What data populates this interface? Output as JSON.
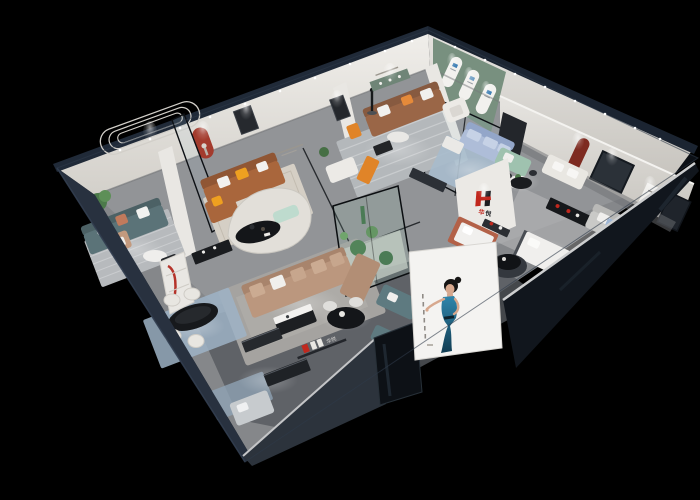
{
  "scene": {
    "kind": "3d-isometric-furniture-showroom-cutaway-render",
    "background": "#000000"
  },
  "brand": {
    "logo_letter": "H",
    "name_cn": "华悦",
    "name_char1": "华",
    "name_char2": "悦",
    "logo_red": "#c1271d",
    "logo_dark": "#1b1c20"
  },
  "palette": {
    "exterior_wall": "#28313f",
    "wall_cap": "#202a38",
    "interior_wall": "#e9e7e3",
    "interior_wall_shade": "#cfccc6",
    "floor": "#85878a",
    "floor_front": "#55595e",
    "green_accent_wall": "#78907f",
    "red_accent": "#b5332a",
    "niche_red": "#a33b2d",
    "niche_maroon": "#7e2b21",
    "sofa_teal": "#5b7378",
    "sofa_cognac": "#a9663c",
    "sofa_brown": "#9a6647",
    "sofa_tan": "#bb977e",
    "sofa_periwinkle": "#aebdd8",
    "sofa_grey": "#c9c9c7",
    "bench_mint": "#bedbce",
    "loveseat_green": "#9fc2af",
    "pillow_terracotta": "#c07a5c",
    "pillow_yellow": "#eea020",
    "accent_orange": "#e08428",
    "rug_blue": "#9db3c6",
    "rug_grey": "#b5b9bc",
    "table_black": "#17191c",
    "poster_background": "#f4f3f1",
    "poster_dress": "#1f6d8c",
    "arch_mark_blue": "#3f7fb5"
  },
  "poster": {
    "subject": "woman in blue evening dress, hand on hip",
    "side_caption": "illegible vertical caption marks"
  },
  "arch_display_wall": {
    "arch_count": 3
  },
  "rooms": [
    {
      "name": "teal-sofa-lounge",
      "items": [
        "teal 3-seat sofa",
        "white and terracotta pillows",
        "potted plant",
        "round side table",
        "black chair",
        "tan armchair",
        "striped rug",
        "oval wall molding"
      ]
    },
    {
      "name": "cognac-leather-lounge",
      "items": [
        "cognac leather sofa with chaise",
        "yellow pillows",
        "black coffee table",
        "red arched niche with sculpture",
        "glass partition",
        "beige rug"
      ]
    },
    {
      "name": "top-center-living",
      "items": [
        "brown leather sofa",
        "white armchair",
        "orange stool and bench",
        "white loveseat",
        "round coffee tables",
        "striped rug",
        "green wall shelf",
        "black sculpture",
        "dark media console"
      ]
    },
    {
      "name": "arched-display-wall",
      "items": [
        "green accent wall",
        "three white arch panels with blue marks"
      ]
    },
    {
      "name": "glass-lounge",
      "items": [
        "periwinkle sofa",
        "white coffee table",
        "dark media wall",
        "glass partition",
        "blue rug"
      ]
    },
    {
      "name": "green-loveseat-corner",
      "items": [
        "sage loveseat",
        "round white table with plant"
      ]
    },
    {
      "name": "right-bedroom-suite",
      "items": [
        "white sofa",
        "grey sofa with blue pillow",
        "white bed",
        "black display rack with red objects",
        "maroon arched niche",
        "dark windows",
        "black round dining table",
        "white art panel"
      ]
    },
    {
      "name": "brand-pillar",
      "items": [
        "red and black H logo",
        "brand characters",
        "dark console"
      ]
    },
    {
      "name": "terracotta-daybed-corner",
      "items": [
        "terracotta daybed with white mattress"
      ]
    },
    {
      "name": "central-living",
      "items": [
        "tan sectional sofa",
        "black and white coffee table",
        "curved white partition",
        "mint bench",
        "black oval table with vases",
        "glass planter atrium with cacti",
        "grey rug"
      ]
    },
    {
      "name": "dining-area",
      "items": [
        "black oval marble dining table",
        "white barrel chairs",
        "display cabinet with red curved accent",
        "black console",
        "blue rug"
      ]
    },
    {
      "name": "reception",
      "items": [
        "round black table",
        "white chairs",
        "teal sofa and ottoman",
        "two dark metal benches",
        "brand logo shelf"
      ]
    },
    {
      "name": "front-bedroom-right",
      "items": [
        "white bed",
        "black round table on dark rug",
        "grey corner sofa"
      ]
    }
  ],
  "lighting": {
    "spotlight_rows": 2,
    "spotlight_color": "#ffffff",
    "floor_light_pools": 13
  }
}
